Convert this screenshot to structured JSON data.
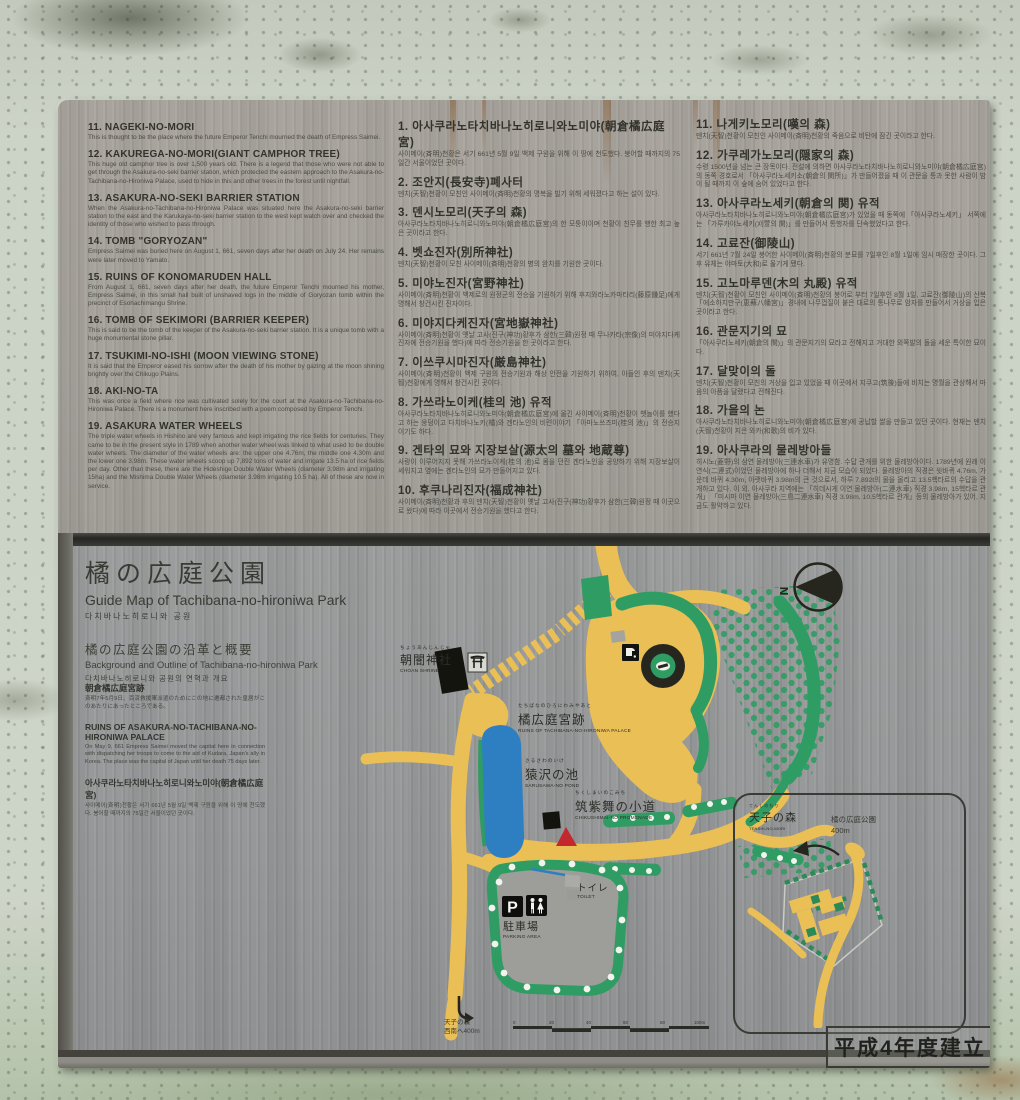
{
  "sign": {
    "erected_label": "平成4年度建立"
  },
  "text_panel": {
    "english_items": [
      {
        "title": "11. NAGEKI-NO-MORI",
        "body": "This is thought to be the place where the future Emperor Tenchi mourned the death of Empress Saimei."
      },
      {
        "title": "12. KAKUREGA-NO-MORI(GIANT CAMPHOR TREE)",
        "body": "This huge old camphor tree is over 1,500 years old. There is a legend that those who were not able to get through the Asakura-no-seki barrier station, which protected the eastern approach to the Asakura-no-Tachibana-no-Hironiwa Palace, used to hide in this and other trees in the forest until nightfall."
      },
      {
        "title": "13. ASAKURA-NO-SEKI BARRIER STATION",
        "body": "When the Asakura-no-Tachibana-no-Hironiwa Palace was situated here the Asakura-no-seki barrier station to the east and the Karukaya-no-seki barrier station to the west kept watch over and checked the identity of those who wished to pass through."
      },
      {
        "title": "14. TOMB \"GORYOZAN\"",
        "body": "Empress Saimei was buried here on August 1, 661, seven days after her death on July 24. Her remains were later moved to Yamato."
      },
      {
        "title": "15. RUINS OF KONOMARUDEN HALL",
        "body": "From August 1, 661, seven days after her death, the future Emperor Tenchi mourned his mother, Empress Saimei, in this small hall built of unshaved logs in the middle of Goryozan tomb within the precinct of Esohachimangu Shrine."
      },
      {
        "title": "16. TOMB OF SEKIMORI (BARRIER KEEPER)",
        "body": "This is said to be the tomb of the keeper of the Asakura-no-seki barrier station. It is a unique tomb with a huge monumental stone pillar."
      },
      {
        "title": "17. TSUKIMI-NO-ISHI (MOON VIEWING STONE)",
        "body": "It is said that the Emperor eased his sorrow after the death of his mother by gazing at the moon shining brightly over the Chikugo Plains."
      },
      {
        "title": "18. AKI-NO-TA",
        "body": "This was once a field where rice was cultivated solely for the court at the Asakura-no-Tachibana-no-Hironiwa Palace. There is a monument here inscribed with a poem composed by Emperor Tenchi."
      },
      {
        "title": "19. ASAKURA WATER WHEELS",
        "body": "The triple water wheels in Hishino are very famous and kept irrigating the rice fields for centuries. They came to be in the present style in 1789 when another water wheel was linked to what used to be double water wheels. The diameter of the water wheels are: the upper one 4.76m, the middle one 4.30m and the lower one 3.98m. These water wheels scoop up 7,892 tons of water and irrigate 13.5 ha of rice fields per day. Other than these, there are the Hideshige Double Water Wheels (diameter 3.98m and irrigating 15ha) and the Mishima Double Water Wheels (diameter 3.98m irrigating 10.5 ha). All of these are now in service."
      }
    ],
    "korean_items_a": [
      {
        "title": "1. 아사쿠라노타치바나노히로니와노미야(朝倉橘広庭宮)",
        "body": "사이메이(斉明)천황은 서기 661년 5월 9일 백제 구원을 위해 이 땅에 천도했다. 붕어할 때까지의 75일간 서울이었던 곳이다."
      },
      {
        "title": "2. 조안지(長安寺)폐사터",
        "body": "덴치(天智)천황이 모친인 사이메이(斉明)천황의 명복을 빌기 위해 세워졌다고 하는 설이 있다."
      },
      {
        "title": "3. 덴시노모리(天子의 森)",
        "body": "아사쿠라노타치바나노히로니와노미야(朝倉橘広庭宮)의 한 모퉁이이며 천황이 친무를 행한 최고 높은 곳이라고 한다."
      },
      {
        "title": "4. 벳쇼진자(別所神社)",
        "body": "덴치(天智)천황이 모친 사이메이(斉明)천황의 병의 완치를 기원한 곳이다."
      },
      {
        "title": "5. 미야노진자(宮野神社)",
        "body": "사이메이(斉明)천황이 백제로의 원정군의 전승을 기원하기 위해 후지와라노카마타리(藤原鎌足)에게 명해서 창건시킨 진자이다."
      },
      {
        "title": "6. 미야지다케진자(宮地嶽神社)",
        "body": "사이메이(斉明)천황이 옛날 고사(진구(神功)황후가 삼한(三韓)원정 때 무나카타(宗像)의 미야지다케진자에 전승기원을 했다)에 따라 전승기원을 한 곳이라고 한다."
      },
      {
        "title": "7. 이쓰쿠시마진자(厳島神社)",
        "body": "사이메이(斉明)천황이 백제 구원의 전승기원과 해상 안전을 기원하기 위하여, 아들인 후의 덴치(天智)천황에게 명해서 창건시킨 곳이다."
      },
      {
        "title": "8. 가쓰라노이케(桂의 池) 유적",
        "body": "아사쿠라노타치바나노히로니와노미야(朝倉橘広庭宮)에 옮긴 사이메이(斉明)천황이 뱃놀이를 했다고 하는 웅덩이고 다치바나노키(橘)와 겐타노인의 비련이야기 「아마노쓰즈미(桂의 池)」의 전승지이기도 하다."
      },
      {
        "title": "9. 겐타의 묘와 지장보살(源太의 墓와 地蔵尊)",
        "body": "사랑이 이루어지지 못해 가쓰라노이케(桂의 池)로 몸을 던진 겐타노인을 공양하기 위해 지장보살이 세워지고 옆에는 겐타노인의 묘가 만들어지고 있다."
      },
      {
        "title": "10. 후쿠나리진자(福成神社)",
        "body": "사이메이(斉明)천황과 후의 덴치(天智)천황이 옛날 고사(진구(神功)황후가 삼한(三韓)원정 때 이곳으로 왔다)에 따라 이곳에서 전승기원을 했다고 한다."
      }
    ],
    "korean_items_b": [
      {
        "title": "11. 나게키노모리(嘆의 森)",
        "body": "덴치(天智)천황이 모친인 사이메이(斉明)천황의 죽음으로 비탄에 잠긴 곳이라고 한다."
      },
      {
        "title": "12. 가쿠레가노모리(隠家의 森)",
        "body": "수령 1500년을 넘는 큰 장목이다. 전설에 의하면 아사쿠라노타치바나노히로니와노미야(朝倉橘広庭宮)의 동쪽 경호로서 「아사쿠라노세키소(朝倉의 関所)」가 만들어졌을 때 이 관문을 통과 못한 사람이 밤이 될 때까지 이 숲에 숨어 있었다고 한다."
      },
      {
        "title": "13. 아사쿠라노세키(朝倉의 関) 유적",
        "body": "아사쿠라노타치바나노히로니와노미야(朝倉橘広庭宮)가 있었을 때 동쪽에 「아사쿠라노세키」 서쪽에는 「가루카야노세키(刈萱의 関)」를 만들어서 통행자를 단속했었다고 한다."
      },
      {
        "title": "14. 고료잔(御陵山)",
        "body": "서기 661년 7월 24일 붕어한 사이메이(斉明)천황의 분묘를 7일후인 8월 1일에 임시 매장한 곳이다. 그후 유체는 야마토(大和)로 옮기게 됐다."
      },
      {
        "title": "15. 고노마루덴(木의 丸殿) 유적",
        "body": "덴치(天智)천황이 모친인 사이메이(斉明)천황의 붕어로 부터 7일후인 8월 1일, 고료잔(御陵山)의 산복 「에소하치만구(恵蘇八幡宮)」경내에 나무껍질이 붙은 대로의 통나무로 암자를 만들어서 거상을 입은 곳이라고 한다."
      },
      {
        "title": "16. 관문지기의 묘",
        "body": "「아사쿠라노세키(朝倉의 関)」의 관문지기의 묘라고 전해지고 거대한 외쪽발의 돌을 세운 특이한 묘이다."
      },
      {
        "title": "17. 달맞이의 돌",
        "body": "덴치(天智)천황이 모친의 거상을 입고 있었을 때 이곳에서 지쿠고(筑後)들에 비치는 명월을 관상해서 마음의 아픔을 달랬다고 전해진다."
      },
      {
        "title": "18. 가을의 논",
        "body": "아사쿠라노타치바나노히로니와노미야(朝倉橘広庭宮)에 공납할 쌀을 만들고 있던 곳이다. 현재는 덴치(天智)천황이 지은 와카(和歌)의 비가 있다."
      },
      {
        "title": "19. 아사쿠라의 물레방아들",
        "body": "히시노(菱野)의 삼연 물레방아(三連水車)가 유명함. 수답 관개를 위한 물레방아이다. 1789년에 원래 이연식(二連式)이었던 물레방아에 하나 더해서 지금 모습이 되었다. 물레방아의 직경은 윗바퀴 4.76m, 가운데 바퀴 4.30m, 아랫바퀴 3.98m의 큰 것으로서, 하루 7,892t의 물을 올리고 13.5헥타르의 수답을 관개하고 있다. 이 외, 아사쿠라 지역에는 「히데시게 이연 물레방아(二連水車) 직경 3.98m, 15헥타르 관개」 「미시마 이연 물레방아(三島二連水車) 직경 3.98m, 10.5헥타르 관개」등의 물레방아가 있어, 지금도 활약하고 있다."
      }
    ]
  },
  "map_panel": {
    "title_jp": "橘の広庭公園",
    "title_en": "Guide Map of Tachibana-no-hironiwa Park",
    "title_kr": "다치바나노히로니와 공원",
    "subtitle_jp": "橘の広庭公園の沿革と概要",
    "subtitle_en": "Background and Outline of Tachibana-no-hironiwa Park",
    "subtitle_kr": "다치바나노히로니와 공원의 연혁과 개요",
    "history": {
      "jp_heading": "朝倉橘広庭宮跡",
      "jp_body": "斉明7年5月9日、百済救援軍派遣のためにこの地に遷都された皇居がこのあたりにあったところである。",
      "en_heading": "RUINS OF ASAKURA-NO-TACHIBANA-NO-HIRONIWA PALACE",
      "en_body": "On May 9, 661 Empress Saimei moved the capital here in connection with dispatching her troops to come to the aid of Kudara, Japan's ally in Korea. The place was the capital of Japan until her death 75 days later.",
      "kr_heading": "아사쿠라노타치바나노히로니와노미야(朝倉橘広庭宮)",
      "kr_body": "사이메이(斉明)천황은 서기 661년 5월 9일 백제 구원을 위해 이 땅에 천도했다. 붕어할 때까지의 75일간 서울이었던 곳이다."
    },
    "labels": {
      "choan": {
        "furigana": "ちょうあんじんじゃ",
        "jp": "朝闇神社",
        "en": "CHOAN SHRINE"
      },
      "palace": {
        "furigana": "たちばなのひろにわみやあと",
        "jp": "橘広庭宮跡",
        "en": "RUINS OF TACHIBANA-NO-HIRONIWA PALACE"
      },
      "pond": {
        "furigana": "さるさわのいけ",
        "jp": "猿沢の池",
        "en": "SARUSAWA-NO POND"
      },
      "promenade": {
        "furigana": "ちくしまいのこみち",
        "jp": "筑紫舞の小道",
        "en": "CHIKUSHIMAI-NO PROMENADE"
      },
      "toilet": {
        "jp": "トイレ",
        "en": "TOILET"
      },
      "parking": {
        "jp": "駐車場",
        "en": "PARKING AREA",
        "p": "P"
      },
      "compass_n": "N",
      "exit_line1": "天子の森",
      "exit_line2": "西南へ400m"
    },
    "scale_bar": {
      "ticks": [
        "0",
        "20",
        "40",
        "60",
        "80",
        "100m"
      ]
    },
    "inset": {
      "furigana": "てんしのもり",
      "jp": "天子の森",
      "en": "TENSHI-NO-MORI",
      "dist_line1": "橘の広庭公園",
      "dist_line2": "400m"
    },
    "colors": {
      "path_yellow": "#eabf55",
      "area_green": "#2f9c63",
      "pond_blue": "#2e7fc2",
      "marker_red": "#c2282e",
      "metal_gray": "#9a9c9a"
    }
  }
}
